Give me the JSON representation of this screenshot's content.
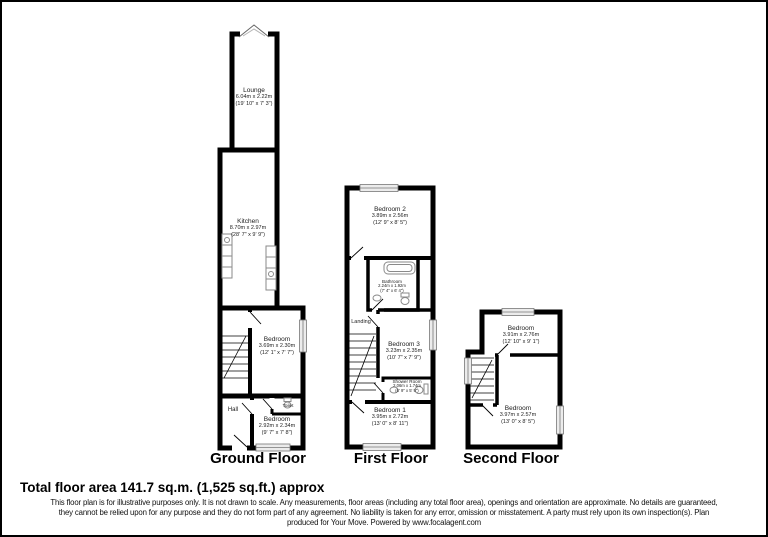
{
  "floors": [
    {
      "title": "Ground Floor",
      "rooms": {
        "lounge": {
          "name": "Lounge",
          "metric": "6.04m x 2.22m",
          "imperial": "(19' 10\" x 7' 3\")"
        },
        "kitchen": {
          "name": "Kitchen",
          "metric": "8.70m x 2.97m",
          "imperial": "(28' 7\" x 9' 9\")"
        },
        "bedroom_mid": {
          "name": "Bedroom",
          "metric": "3.69m x 2.30m",
          "imperial": "(12' 1\" x 7' 7\")"
        },
        "hall": {
          "name": "Hall"
        },
        "toilet": {
          "name": "Toilet"
        },
        "bedroom_bottom": {
          "name": "Bedroom",
          "metric": "2.92m x 2.34m",
          "imperial": "(9' 7\" x 7' 8\")"
        }
      }
    },
    {
      "title": "First Floor",
      "rooms": {
        "bedroom2": {
          "name": "Bedroom 2",
          "metric": "3.89m x 2.56m",
          "imperial": "(12' 9\" x 8' 5\")"
        },
        "bathroom": {
          "name": "Bathroom",
          "metric": "2.24m x 1.92m",
          "imperial": "(7' 4\" x 6' 4\")"
        },
        "landing": {
          "name": "Landing"
        },
        "bedroom3": {
          "name": "Bedroom 3",
          "metric": "3.23m x 2.35m",
          "imperial": "(10' 7\" x 7' 9\")"
        },
        "shower": {
          "name": "Shower Room",
          "metric": "2.06m x 1.74m",
          "imperial": "(6' 9\" x 5' 9\")"
        },
        "bedroom1": {
          "name": "Bedroom 1",
          "metric": "3.95m x 2.72m",
          "imperial": "(13' 0\" x 8' 11\")"
        }
      }
    },
    {
      "title": "Second Floor",
      "rooms": {
        "bedroom_top": {
          "name": "Bedroom",
          "metric": "3.91m x 2.76m",
          "imperial": "(12' 10\" x 9' 1\")"
        },
        "bedroom_bottom": {
          "name": "Bedroom",
          "metric": "3.97m x 2.57m",
          "imperial": "(13' 0\" x 8' 5\")"
        }
      }
    }
  ],
  "footer": {
    "total_area": "Total floor area 141.7 sq.m. (1,525 sq.ft.) approx",
    "disclaimer_lines": [
      "This floor plan is for illustrative purposes only. It is not drawn to scale. Any measurements, floor areas (including any total floor area), openings and orientation are approximate. No details are guaranteed,",
      "they cannot be relied upon for any purpose and they do not form part of any agreement. No liability is taken for any error, omission or misstatement. A party must rely upon its own inspection(s).  Plan",
      "produced for Your Move. Powered by www.focalagent.com"
    ]
  },
  "colors": {
    "wall": "#000000",
    "background": "#ffffff",
    "window": "#ececec",
    "fixture": "#8a8a8a"
  }
}
